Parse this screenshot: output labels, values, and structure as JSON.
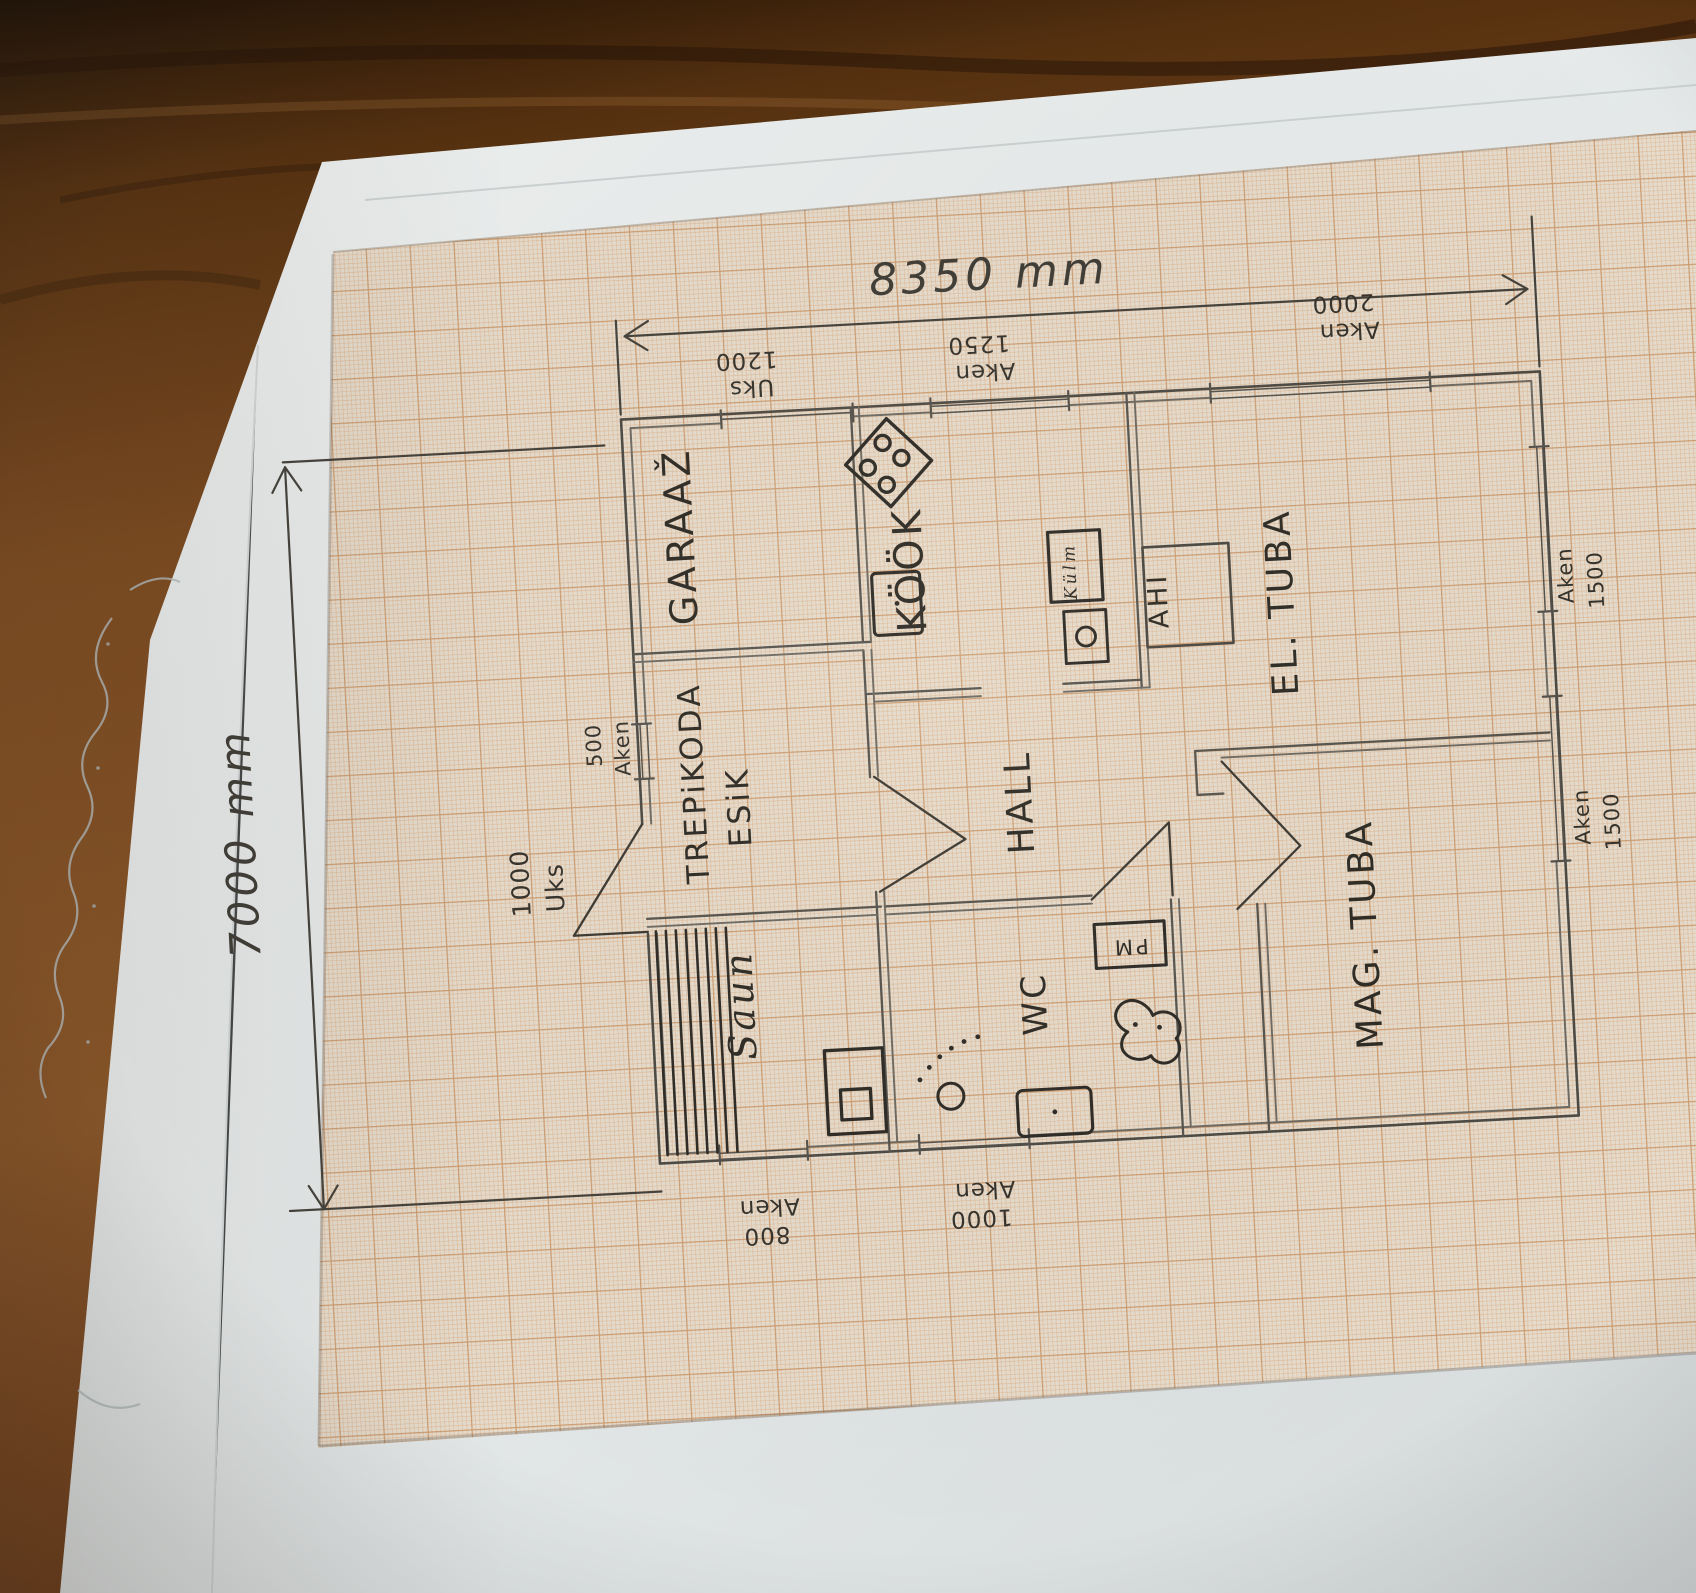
{
  "palette": {
    "wood": "#6e3e1b",
    "white_sheet": "#e8ebeb",
    "graph_paper": "#e6dccd",
    "grid_fine": "#dcb48e",
    "grid_bold": "#cc9a6c",
    "pencil": "#55524c",
    "ink": "#2e2b26"
  },
  "dimensions": {
    "width": "8350 mm",
    "height": "7000 mm"
  },
  "rooms": {
    "garage": "GARAAŽ",
    "stairhall": "TREPiKODA",
    "entry": "ESiK",
    "kitchen": "KÖÖK",
    "heater": "AHI",
    "living": "EL. TUBA",
    "hall": "HALL",
    "bedroom": "MAG. TUBA",
    "sauna": "Saun",
    "wc": "WC"
  },
  "fixtures": {
    "fridge": "Külm",
    "washing_machine": "PM"
  },
  "openings": {
    "garage_door": {
      "line1": "Uks",
      "line2": "1200"
    },
    "kitchen_window": {
      "line1": "Aken",
      "line2": "1250"
    },
    "living_window_top": {
      "line1": "Aken",
      "line2": "2000"
    },
    "stairhall_window": {
      "line1": "500",
      "line2": "Aken"
    },
    "entry_door": {
      "line1": "1000",
      "line2": "Uks"
    },
    "sauna_window": {
      "line1": "Aken",
      "line2": "800"
    },
    "wc_window": {
      "line1": "Aken",
      "line2": "1000"
    },
    "living_window_right": {
      "line1": "Aken",
      "line2": "1500"
    },
    "bedroom_window_right": {
      "line1": "Aken",
      "line2": "1500"
    }
  }
}
